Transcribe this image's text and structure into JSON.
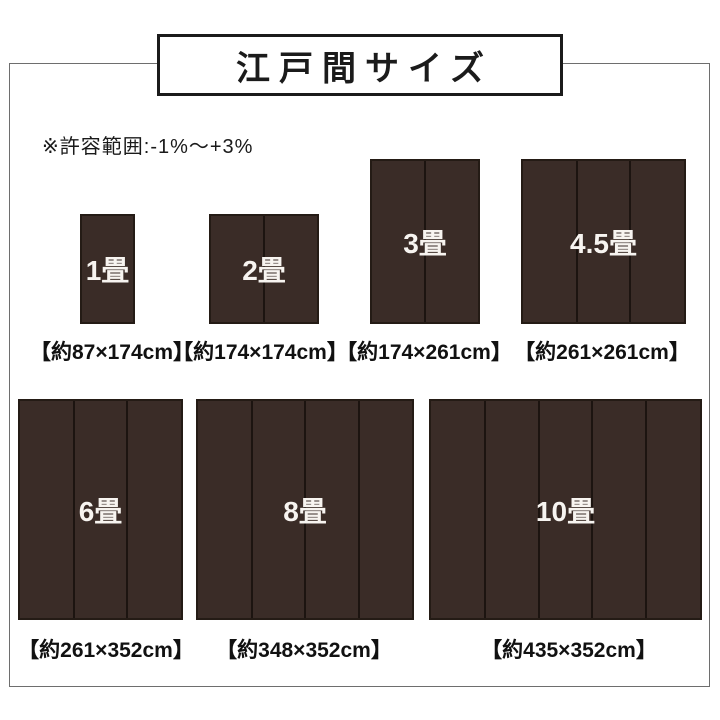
{
  "title": "江戸間サイズ",
  "note": "※許容範囲:-1%〜+3%",
  "mats": [
    {
      "label": "1畳",
      "dimensions": "【約87×174cm】",
      "panels": 1
    },
    {
      "label": "2畳",
      "dimensions": "【約174×174cm】",
      "panels": 2
    },
    {
      "label": "3畳",
      "dimensions": "【約174×261cm】",
      "panels": 2
    },
    {
      "label": "4.5畳",
      "dimensions": "【約261×261cm】",
      "panels": 3
    },
    {
      "label": "6畳",
      "dimensions": "【約261×352cm】",
      "panels": 3
    },
    {
      "label": "8畳",
      "dimensions": "【約348×352cm】",
      "panels": 4
    },
    {
      "label": "10畳",
      "dimensions": "【約435×352cm】",
      "panels": 5
    }
  ],
  "colors": {
    "mat_fill": "#3a2c27",
    "mat_border": "#241b15",
    "panel_divider": "#1c1410",
    "frame_border": "#6e6e6e",
    "title_border": "#1b1b1b",
    "text": "#1a1a1a",
    "mat_label_text": "#f7f4f0",
    "background": "#ffffff"
  }
}
